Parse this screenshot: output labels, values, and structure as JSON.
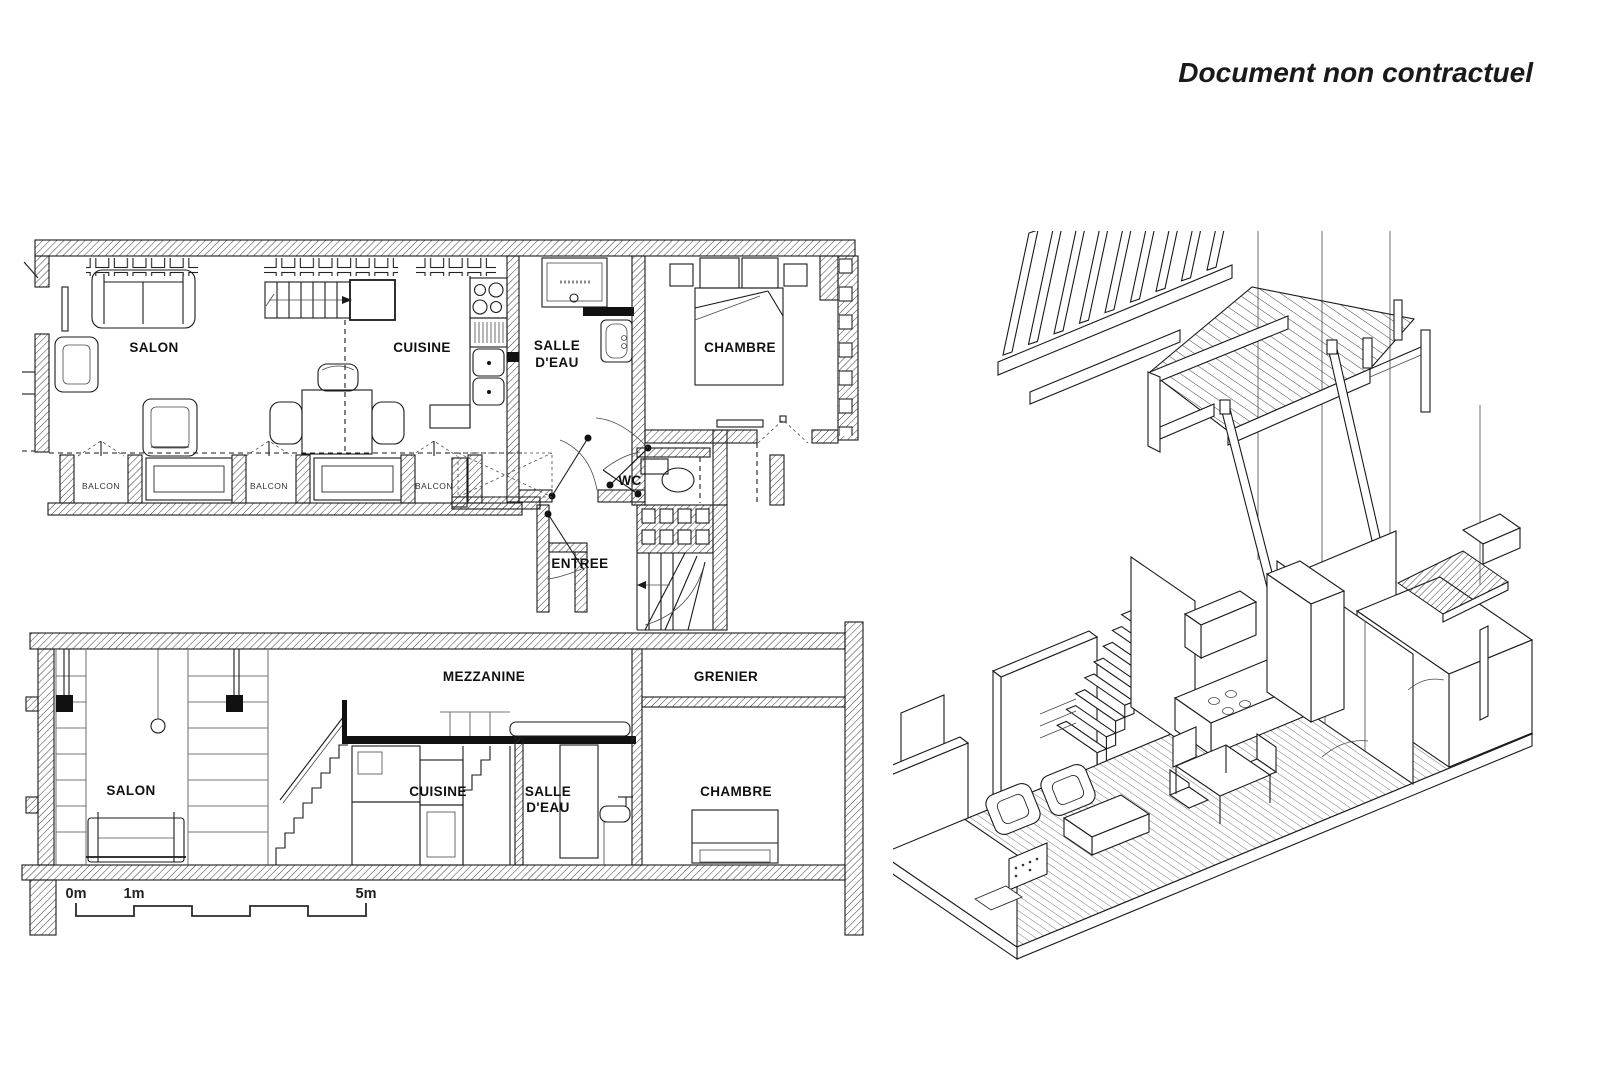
{
  "disclaimer": "Document non contractuel",
  "colors": {
    "line": "#1a1a1a",
    "hatch": "#3a3a3a",
    "background": "#ffffff"
  },
  "floor_plan": {
    "rooms": {
      "salon": "SALON",
      "cuisine": "CUISINE",
      "salle_deau_line1": "SALLE",
      "salle_deau_line2": "D'EAU",
      "chambre": "CHAMBRE",
      "wc": "WC",
      "entree": "ENTREE",
      "balcon": "BALCON"
    }
  },
  "section": {
    "rooms": {
      "salon": "SALON",
      "cuisine": "CUISINE",
      "salle_deau_line1": "SALLE",
      "salle_deau_line2": "D'EAU",
      "mezzanine": "MEZZANINE",
      "grenier": "GRENIER",
      "chambre": "CHAMBRE"
    },
    "scale_bar": {
      "m0": "0m",
      "m1": "1m",
      "m5": "5m"
    }
  }
}
